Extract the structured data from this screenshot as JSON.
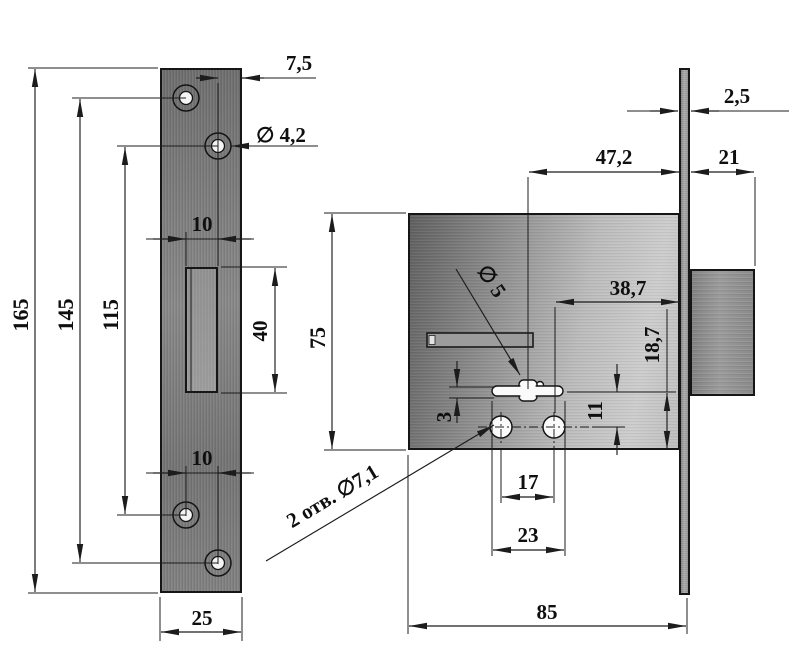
{
  "drawing_type": "lock-technical-drawing",
  "colors": {
    "line": "#1c1c1c",
    "metal_dark": "#6e6e6e",
    "metal_light": "#cdcdcd",
    "background": "#ffffff"
  },
  "strike_plate_view": {
    "plate_height": "165",
    "outer_holes_spacing": "145",
    "inner_holes_spacing": "115",
    "upper_holes_offset": "10",
    "cutout_height": "40",
    "lower_holes_offset": "10",
    "plate_width": "25",
    "hole_edge_distance": "7,5",
    "screw_hole_diameter": "∅ 4,2"
  },
  "lock_body_view": {
    "faceplate_thickness": "2,5",
    "keyhole_to_faceplate": "47,2",
    "bolt_length": "21",
    "body_height": "75",
    "hole_to_faceplate": "38,7",
    "keyhole_pin_diameter": "∅ 5",
    "keyhole_to_bottom": "18,7",
    "keyhole_to_holes": "11",
    "keyhole_offset": "3",
    "holes_spacing": "17",
    "keyhole_length": "23",
    "body_width": "85",
    "mounting_holes_label": "2 отв. ∅7,1"
  }
}
